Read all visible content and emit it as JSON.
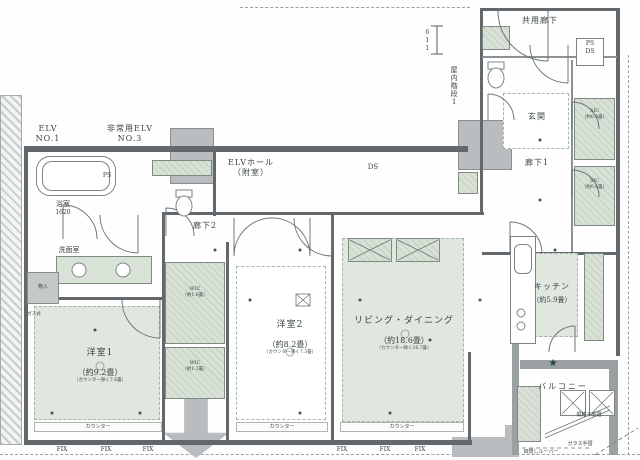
{
  "common": {
    "shared_corridor": "共用廊下",
    "indoor_stairs": "屋内階段1",
    "elv_hall_1": "ELVホール",
    "elv_hall_2": "（附室）",
    "elv1_1": "ELV",
    "elv1_2": "NO.1",
    "elv3_1": "非常用ELV",
    "elv3_2": "NO.3",
    "ps": "PS",
    "ds": "DS",
    "dim_611": "611"
  },
  "rooms": {
    "bath": {
      "name": "浴室",
      "size": "1620"
    },
    "washroom": {
      "name": "洗面室"
    },
    "storage": {
      "name": "物入"
    },
    "bed1": {
      "name": "洋室1",
      "size": "（約9.2畳）",
      "note": "（カウンター除く7.6畳）"
    },
    "bed2": {
      "name": "洋室2",
      "size": "（約8.2畳）",
      "note": "（カウンター除く7.3畳）"
    },
    "living": {
      "name": "リビング・ダイニング",
      "size": "（約18.6畳）",
      "note": "（カウンター除く16.7畳）"
    },
    "kitchen": {
      "name": "キッチン",
      "size": "（約5.9畳）"
    },
    "wic1": {
      "name": "WIC",
      "size": "（約1.6畳）"
    },
    "wic2": {
      "name": "WIC",
      "size": "（約1.2畳）"
    },
    "sic1": {
      "name": "SIC",
      "size": "（約0.8畳）"
    },
    "sic2": {
      "name": "SIC",
      "size": "（約0.6畳）"
    },
    "genkan": {
      "name": "玄関"
    },
    "corridor1": {
      "name": "廊下1"
    },
    "corridor2": {
      "name": "廊下2"
    },
    "balcony": {
      "name": "バルコニー"
    }
  },
  "annotations": {
    "counter": "カウンター",
    "fix": "FIX",
    "gas": "ガス式",
    "glass_rail": "ガラス手摺",
    "louver": "目隠しルーバー",
    "lattice_rail": "縦格子手摺",
    "star": "★",
    "ps_small": "PS"
  },
  "colors": {
    "wall": "#62686c",
    "shaft_gray": "#b9bdbf",
    "room_tint": "#e0e7df",
    "closet_tint": "#cfd9cc",
    "balcony_wall": "#9ba0a2",
    "line": "#6f767a",
    "text": "#3a4443"
  }
}
